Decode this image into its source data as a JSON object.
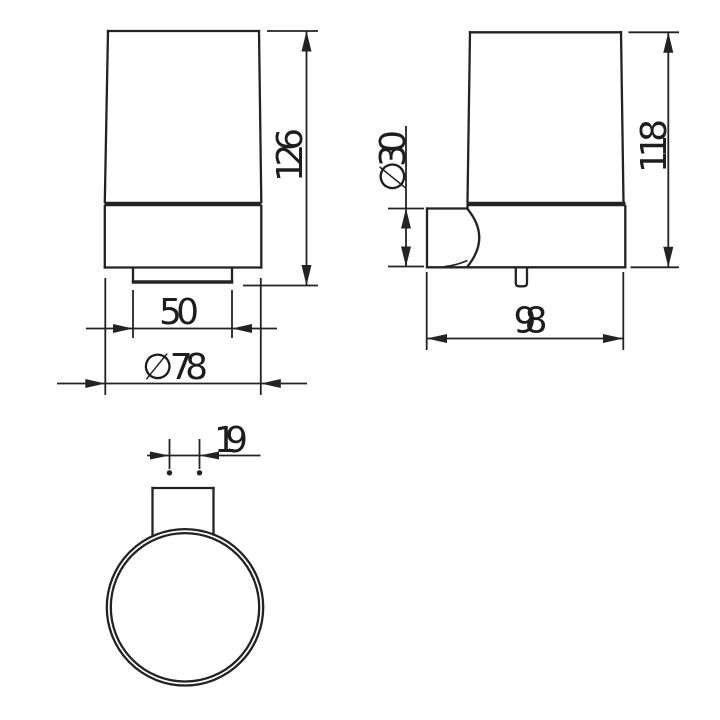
{
  "drawing": {
    "type": "technical-orthographic-views",
    "subject": "wall-mounted tumbler holder",
    "colors": {
      "background": "#ffffff",
      "line": "#232323",
      "text": "#1d1d1d"
    },
    "views": {
      "front": {
        "height": "126",
        "base_width": "50",
        "diameter": "∅ 78"
      },
      "side": {
        "height": "118",
        "bracket_diameter": "∅ 30",
        "depth": "98"
      },
      "top": {
        "bracket_width": "19"
      }
    }
  }
}
